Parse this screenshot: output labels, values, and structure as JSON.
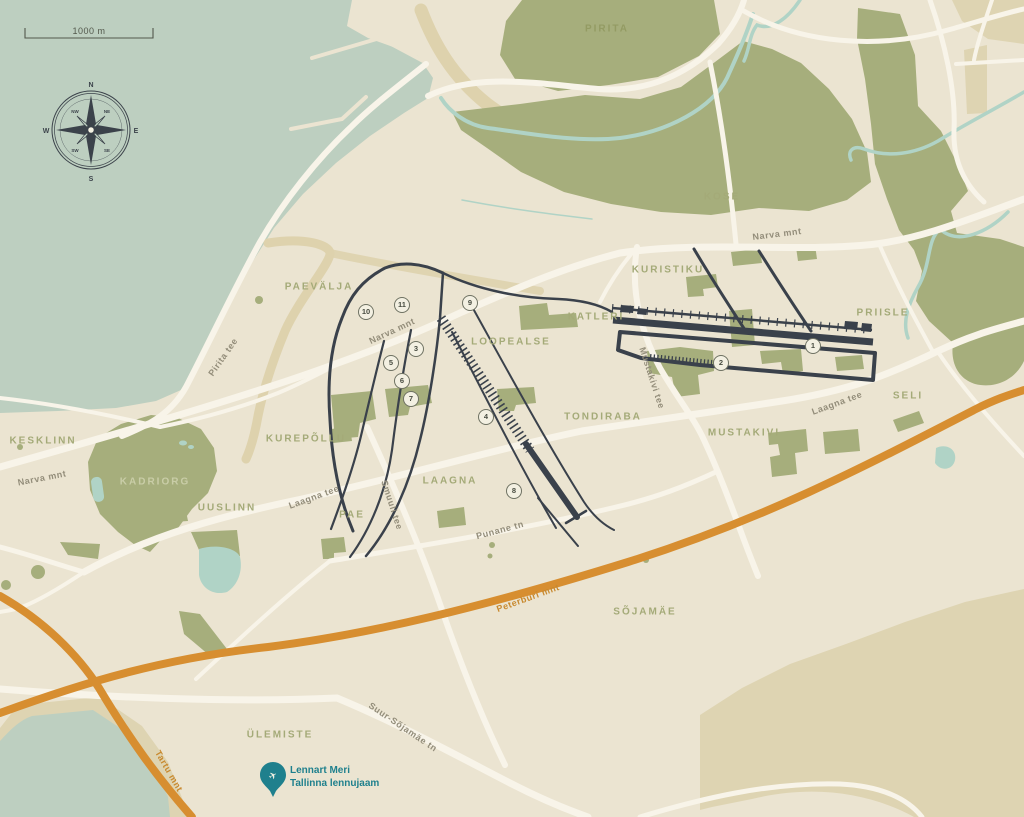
{
  "map": {
    "scale_bar": {
      "label": "1000 m"
    },
    "compass": {
      "n": "N",
      "e": "E",
      "s": "S",
      "w": "W",
      "ne": "NE",
      "nw": "NW",
      "se": "SE",
      "sw": "SW"
    },
    "airport": {
      "line1": "Lennart Meri",
      "line2": "Tallinna lennujaam"
    },
    "districts": [
      {
        "text": "PIRITA",
        "x": 607,
        "y": 29,
        "rot": 0,
        "style": "on-green"
      },
      {
        "text": "KOSE",
        "x": 722,
        "y": 197,
        "rot": 0
      },
      {
        "text": "KURISTIKU",
        "x": 668,
        "y": 270,
        "rot": 0
      },
      {
        "text": "PRIISLE",
        "x": 883,
        "y": 313,
        "rot": 0
      },
      {
        "text": "KATLERI",
        "x": 596,
        "y": 317,
        "rot": 0
      },
      {
        "text": "LOOPEALSE",
        "x": 511,
        "y": 342,
        "rot": 0
      },
      {
        "text": "PAEVÄLJA",
        "x": 319,
        "y": 287,
        "rot": 0
      },
      {
        "text": "TONDIRABA",
        "x": 603,
        "y": 417,
        "rot": 0
      },
      {
        "text": "MUSTAKIVI",
        "x": 744,
        "y": 433,
        "rot": 0
      },
      {
        "text": "SELI",
        "x": 908,
        "y": 396,
        "rot": 0
      },
      {
        "text": "KESKLINN",
        "x": 43,
        "y": 441,
        "rot": 0
      },
      {
        "text": "KADRIORG",
        "x": 155,
        "y": 482,
        "rot": 0,
        "style": "on-green-light"
      },
      {
        "text": "KUREPÕLLU",
        "x": 306,
        "y": 439,
        "rot": 0
      },
      {
        "text": "UUSLINN",
        "x": 227,
        "y": 508,
        "rot": 0
      },
      {
        "text": "PAE",
        "x": 352,
        "y": 515,
        "rot": 0
      },
      {
        "text": "LAAGNA",
        "x": 450,
        "y": 481,
        "rot": 0
      },
      {
        "text": "SÕJAMÄE",
        "x": 645,
        "y": 612,
        "rot": 0
      },
      {
        "text": "ÜLEMISTE",
        "x": 280,
        "y": 735,
        "rot": 0
      }
    ],
    "road_labels": [
      {
        "text": "Narva mnt",
        "x": 777,
        "y": 234,
        "rot": -7
      },
      {
        "text": "Narva mnt",
        "x": 392,
        "y": 331,
        "rot": -25
      },
      {
        "text": "Narva mnt",
        "x": 42,
        "y": 478,
        "rot": -11
      },
      {
        "text": "Pirita tee",
        "x": 223,
        "y": 357,
        "rot": -55
      },
      {
        "text": "Laagna tee",
        "x": 314,
        "y": 497,
        "rot": -20
      },
      {
        "text": "Laagna tee",
        "x": 837,
        "y": 403,
        "rot": -20
      },
      {
        "text": "Mustakivi tee",
        "x": 652,
        "y": 378,
        "rot": 72
      },
      {
        "text": "Smuuli tee",
        "x": 392,
        "y": 505,
        "rot": 72
      },
      {
        "text": "Punane tn",
        "x": 500,
        "y": 530,
        "rot": -15
      },
      {
        "text": "Suur-Sõjamäe tn",
        "x": 403,
        "y": 727,
        "rot": 34
      },
      {
        "text": "Peterburi mnt",
        "x": 528,
        "y": 598,
        "rot": -20,
        "style": "orange"
      },
      {
        "text": "Tartu mnt",
        "x": 169,
        "y": 771,
        "rot": 60,
        "style": "orange"
      }
    ],
    "markers": [
      {
        "n": "1",
        "x": 813,
        "y": 346
      },
      {
        "n": "2",
        "x": 721,
        "y": 363
      },
      {
        "n": "3",
        "x": 416,
        "y": 349
      },
      {
        "n": "4",
        "x": 486,
        "y": 417
      },
      {
        "n": "5",
        "x": 391,
        "y": 363
      },
      {
        "n": "6",
        "x": 402,
        "y": 381
      },
      {
        "n": "7",
        "x": 411,
        "y": 399
      },
      {
        "n": "8",
        "x": 514,
        "y": 491
      },
      {
        "n": "9",
        "x": 470,
        "y": 303
      },
      {
        "n": "10",
        "x": 366,
        "y": 312
      },
      {
        "n": "11",
        "x": 402,
        "y": 305
      }
    ],
    "colors": {
      "sea": "#bdcfc0",
      "land": "#ebe4d1",
      "land_shade": "#ded4b2",
      "forest": "#a6ae7c",
      "water_feature": "#b0d3c6",
      "road": "#f8f4e9",
      "road_orange": "#d78e30",
      "rail_dark": "#3a414b",
      "district_label": "#a4aa78",
      "road_label": "#938d7a",
      "airport_teal": "#1f808d"
    }
  }
}
